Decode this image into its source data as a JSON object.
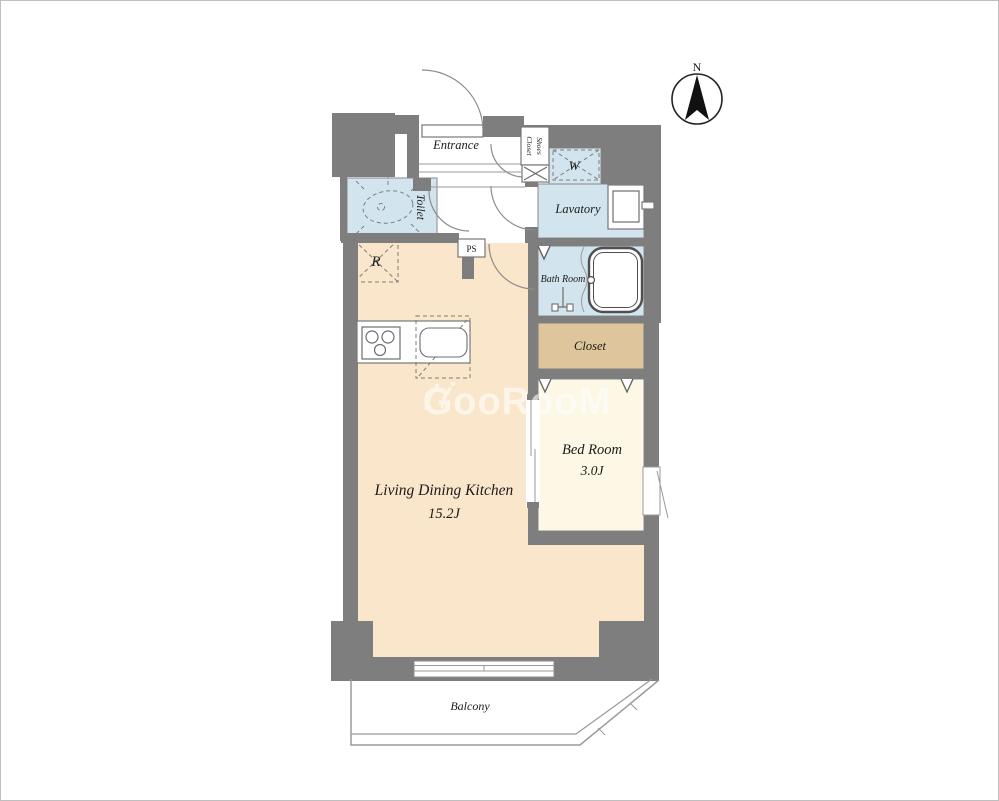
{
  "plan": {
    "rooms": {
      "entrance": {
        "label": "Entrance"
      },
      "shoes_closet": {
        "label_line1": "Shoes",
        "label_line2": "Closet"
      },
      "washer": {
        "label": "W"
      },
      "lavatory": {
        "label": "Lavatory"
      },
      "toilet": {
        "label": "Toilet"
      },
      "bath": {
        "label": "Bath Room"
      },
      "closet": {
        "label": "Closet"
      },
      "bedroom": {
        "label": "Bed Room",
        "area": "3.0J"
      },
      "ldk": {
        "label": "Living Dining Kitchen",
        "area": "15.2J"
      },
      "balcony": {
        "label": "Balcony"
      }
    },
    "annotations": {
      "pipe_space": "PS",
      "refrigerator": "R"
    },
    "compass": {
      "north_label": "N"
    },
    "watermark": {
      "text": "GooRooM"
    },
    "colors": {
      "wall": "#7e7e7e",
      "ldk_floor": "#fae6ca",
      "bedroom_floor": "#fcf8e5",
      "wet_area_floor": "#d2e5ee",
      "closet_floor": "#dfc59c",
      "outline": "#8a8a8a"
    }
  }
}
